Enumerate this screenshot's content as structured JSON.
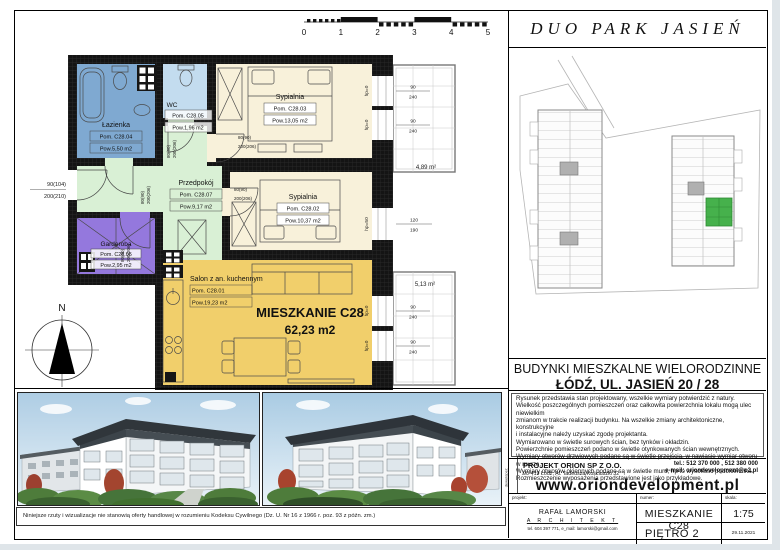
{
  "header": {
    "project_title": "DUO PARK JASIEŃ"
  },
  "scale_bar": {
    "ticks": [
      "0",
      "1",
      "2",
      "3",
      "4",
      "5"
    ]
  },
  "floorplan": {
    "apartment": {
      "name": "MIESZKANIE C28",
      "area": "62,23 m2"
    },
    "rooms": {
      "salon": {
        "name": "Salon z an. kuchennym",
        "id": "Pom. C28.01",
        "area": "Pow.19,23 m2"
      },
      "sypialnia2": {
        "name": "Sypialnia",
        "id": "Pom. C28.02",
        "area": "Pow.10,37 m2"
      },
      "sypialnia3": {
        "name": "Sypialnia",
        "id": "Pom. C28.03",
        "area": "Pow.13,05 m2"
      },
      "lazienka": {
        "name": "Łazienka",
        "id": "Pom. C28.04",
        "area": "Pow.5,50 m2"
      },
      "wc": {
        "name": "WC",
        "id": "Pom. C28.05",
        "area": "Pow.1,96 m2"
      },
      "garderoba": {
        "name": "Garderoba",
        "id": "Pom. C28.06",
        "area": "Pow.2,95 m2"
      },
      "przedpokoj": {
        "name": "Przedpokój",
        "id": "Pom. C28.07",
        "area": "Pow.9,17 m2"
      }
    },
    "balconies": {
      "top": "4,89 m²",
      "bottom": "5,13 m²"
    },
    "doors": {
      "entrance": [
        "90(104)",
        "200(210)"
      ],
      "interior": [
        "80(90)",
        "200(206)"
      ]
    },
    "windows": {
      "w90": "90",
      "h240": "240",
      "w120": "120",
      "h190": "190",
      "hp0": "hp=0",
      "hp50": "hp=50"
    },
    "compass": "N"
  },
  "address": {
    "line1": "BUDYNKI MIESZKALNE WIELORODZINNE",
    "line2": "ŁÓDŹ, UL. JASIEŃ 20 / 28"
  },
  "notes": {
    "lines": [
      "Rysunek przedstawia stan projektowany, wszelkie wymiary potwierdzić z natury.",
      "Wielkość poszczególnych pomieszczeń oraz całkowita powierzchnia lokalu mogą ulec niewielkim",
      "zmianom w trakcie realizacji budynku. Na wszelkie zmiany architektoniczne, konstrukcyjne",
      "i instalacyjne należy uzyskać zgodę projektanta.",
      "Wymiarowano w świetle surowych ścian, bez tynków i okładzin.",
      "Powierzchnie pomieszczeń podano w świetle otynkowanych ścian wewnętrznych.",
      "Wymiary otworów drzwiowych podane są w świetle przejścia, w nawiasie wymiar otworu w murze.",
      "Wymiary otworów okiennych podane są w świetle muru, hp to wysokość podokiennika.",
      "Rozmieszczenie wyposażenia przedstawione jest jako przykładowe."
    ]
  },
  "developer": {
    "side_label": "deweloper:",
    "company": "PROJEKT ORION SP Z O.O.",
    "address": "90-419 Łódź, Al. Tadeusza Kościuszki 32",
    "phone": "tel.: 512 370 000 , 512 380 000",
    "email": "e-mail: oriondevelopment@o2.pl",
    "website": "www.oriondevelopment.pl"
  },
  "titleblock": {
    "projekt_label": "projekt:",
    "numer_label": "numer:",
    "skala_label": "skala:",
    "architect_name": "RAFAŁ LAMORSKI",
    "architect_title": "A R C H I T E K T",
    "architect_contact": "tel. 604 397 771,    e_mail: lamorski@gmail.com",
    "unit": "MIESZKANIE  C28",
    "scale": "1:75",
    "floor": "PIĘTRO 2",
    "date": "29.11.2021"
  },
  "photos_disclaimer": "Niniejsze rzuty i wizualizacje nie stanowią oferty handlowej w rozumieniu Kodeksu Cywilnego (Dz. U. Nr 16 z 1966 r. poz. 93 z późn. zm.)",
  "colors": {
    "bathroom": "#7fa9d1",
    "wc": "#c3dcef",
    "bedroom": "#f8f1da",
    "hall": "#d9f0d5",
    "wardrobe": "#9478dd",
    "living": "#f1cf6b",
    "wall": "#141414",
    "highlight_apartment": "#46b14c"
  }
}
